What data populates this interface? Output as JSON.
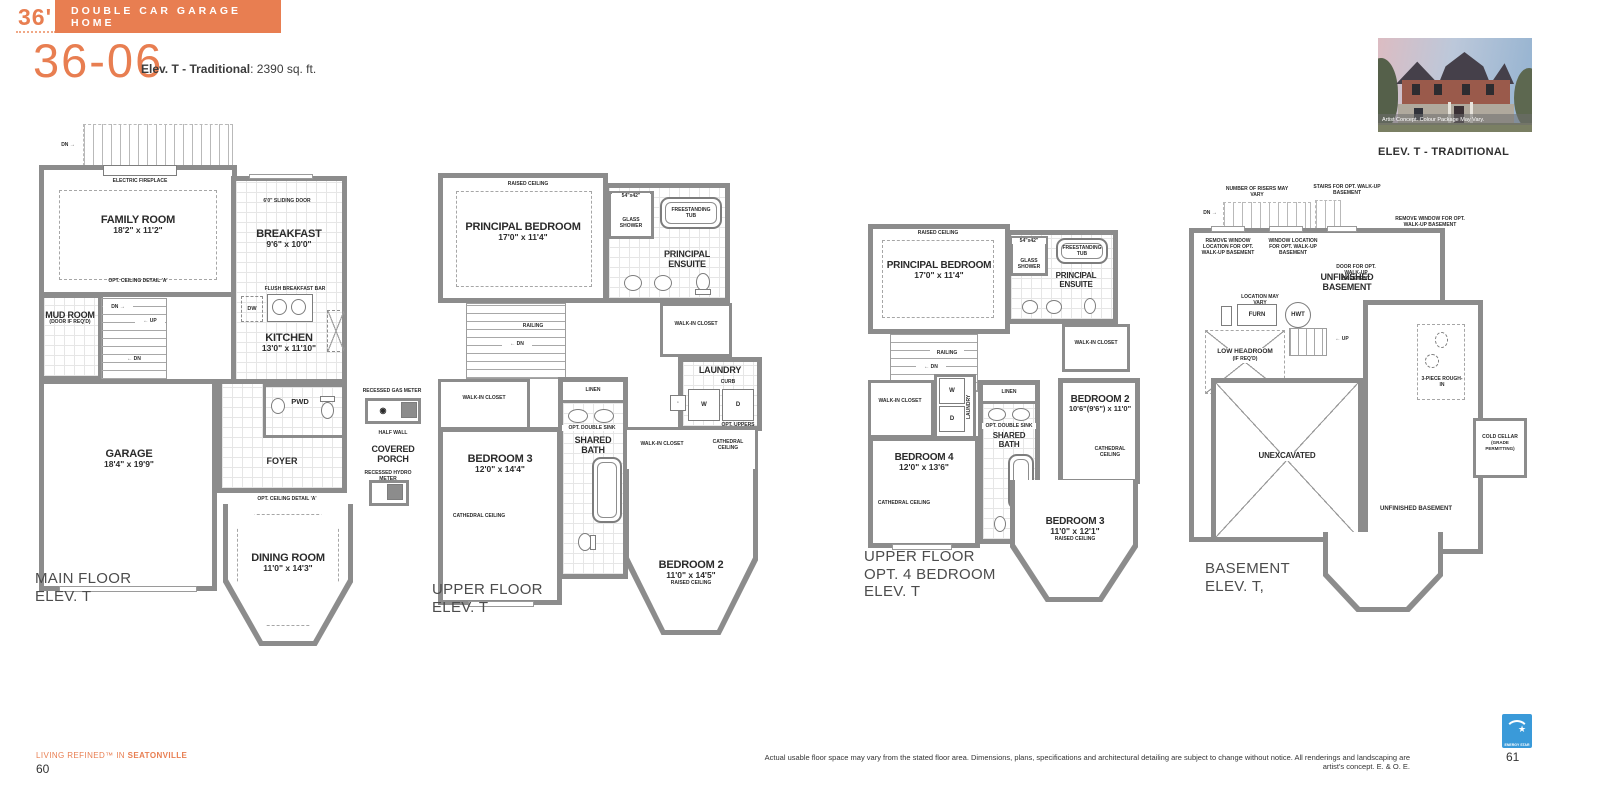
{
  "colors": {
    "accent": "#E87E51",
    "wall": "#8C8C8C",
    "energy_blue": "#3A9AD9"
  },
  "header": {
    "frontage": "36'",
    "banner": "DOUBLE CAR GARAGE HOME",
    "model": "36-06",
    "elev": "Elev. T - Traditional",
    "sqft": ": 2390 sq. ft."
  },
  "photo": {
    "caption": "Artist Concept. Colour Package May Vary.",
    "label": "ELEV. T - TRADITIONAL"
  },
  "plan_main": {
    "caption1": "MAIN FLOOR",
    "caption2": "ELEV. T",
    "family": {
      "name": "FAMILY ROOM",
      "dims": "18'2\" x 11'2\""
    },
    "breakfast": {
      "name": "BREAKFAST",
      "dims": "9'6\" x 10'0\""
    },
    "kitchen": {
      "name": "KITCHEN",
      "dims": "13'0\" x 11'10\""
    },
    "garage": {
      "name": "GARAGE",
      "dims": "18'4\" x 19'9\""
    },
    "dining": {
      "name": "DINING ROOM",
      "dims": "11'0\" x 14'3\""
    },
    "mudroom": {
      "name": "MUD ROOM",
      "note": "(DOOR IF REQ'D)"
    },
    "foyer": "FOYER",
    "pwd": "PWD",
    "covered_porch": "COVERED PORCH",
    "ann": {
      "electric_fireplace": "ELECTRIC FIREPLACE",
      "opt_ceiling": "OPT. CEILING DETAIL 'A'",
      "sliding_door": "6'0\" SLIDING DOOR",
      "flush_bar": "FLUSH BREAKFAST BAR",
      "dw": "DW",
      "recessed_gas": "RECESSED GAS METER",
      "half_wall": "HALF WALL",
      "recessed_hydro": "RECESSED HYDRO METER",
      "door_grade": "DOOR WHERE GRADE PERMITS",
      "dn_right": "DN →",
      "up_left": "← UP",
      "dn_left": "← DN"
    }
  },
  "plan_upper": {
    "caption1": "UPPER FLOOR",
    "caption2": "ELEV. T",
    "principal": {
      "name": "PRINCIPAL BEDROOM",
      "dims": "17'0\" x 11'4\"",
      "raised": "RAISED CEILING"
    },
    "ensuite": "PRINCIPAL ENSUITE",
    "shower": {
      "dims": "54\"x42\"",
      "name": "GLASS SHOWER"
    },
    "tub": "FREESTANDING TUB",
    "wic": "WALK-IN CLOSET",
    "laundry": {
      "name": "LAUNDRY",
      "curb": "CURB",
      "w": "W",
      "d": "D",
      "uppers": "OPT. UPPERS"
    },
    "railing": "RAILING",
    "dn": "← DN",
    "linen": "LINEN",
    "opt_double_sink": "OPT. DOUBLE SINK",
    "shared_bath": "SHARED BATH",
    "bedroom3": {
      "name": "BEDROOM 3",
      "dims": "12'0\" x 14'4\"",
      "cathedral": "CATHEDRAL CEILING"
    },
    "bedroom2": {
      "name": "BEDROOM 2",
      "dims": "11'0\" x 14'5\"",
      "raised": "RAISED CEILING",
      "cathedral": "CATHEDRAL CEILING"
    }
  },
  "plan_opt4": {
    "caption1": "UPPER FLOOR",
    "caption2": "OPT. 4 BEDROOM",
    "caption3": "ELEV. T",
    "principal": {
      "name": "PRINCIPAL BEDROOM",
      "dims": "17'0\" x 11'4\"",
      "raised": "RAISED CEILING"
    },
    "ensuite": "PRINCIPAL ENSUITE",
    "shower": {
      "dims": "54\"x42\"",
      "name": "GLASS SHOWER"
    },
    "tub": "FREESTANDING TUB",
    "wic": "WALK-IN CLOSET",
    "laundry": {
      "name": "LAUNDRY",
      "w": "W",
      "d": "D"
    },
    "railing": "RAILING",
    "dn": "← DN",
    "linen": "LINEN",
    "opt_double_sink": "OPT. DOUBLE SINK",
    "shared_bath": "SHARED BATH",
    "bedroom4": {
      "name": "BEDROOM 4",
      "dims": "12'0\" x 13'6\"",
      "cathedral": "CATHEDRAL CEILING"
    },
    "bedroom2": {
      "name": "BEDROOM 2",
      "dims": "10'6\"(9'6\") x 11'0\"",
      "cathedral": "CATHEDRAL CEILING"
    },
    "bedroom3": {
      "name": "BEDROOM 3",
      "dims": "11'0\" x 12'1\"",
      "raised": "RAISED CEILING"
    }
  },
  "plan_basement": {
    "caption1": "BASEMENT",
    "caption2": "ELEV. T,",
    "num_risers": "NUMBER OF RISERS MAY VARY",
    "stairs_opt": "STAIRS FOR OPT. WALK-UP BASEMENT",
    "remove_window_loc": "REMOVE WINDOW LOCATION FOR OPT. WALK-UP BASEMENT",
    "window_loc": "WINDOW LOCATION FOR OPT. WALK-UP BASEMENT",
    "door_opt": "DOOR FOR OPT. WALK-UP BASEMENT",
    "remove_window": "REMOVE WINDOW FOR OPT. WALK-UP BASEMENT",
    "unfinished": "UNFINISHED BASEMENT",
    "location_vary": "LOCATION MAY VARY",
    "furn": "FURN",
    "hwt": "HWT",
    "low_headroom": "LOW HEADROOM",
    "low_headroom_note": "(IF REQ'D)",
    "up": "← UP",
    "dn": "DN →",
    "unexcavated": "UNEXCAVATED",
    "three_piece": "3-PIECE ROUGH-IN",
    "cold_cellar": "COLD CELLAR",
    "cold_cellar_note": "(GRADE PERMITTING)",
    "unfinished2": "UNFINISHED BASEMENT"
  },
  "footer": {
    "tagline_pre": "LIVING REFINED™ IN ",
    "tagline_bold": "SEATONVILLE",
    "page_left": "60",
    "disclaimer": "Actual usable floor space may vary from the stated floor area. Dimensions, plans, specifications and architectural detailing are subject to change without notice. All renderings and landscaping are artist's concept. E. & O. E.",
    "page_right": "61",
    "energy_label": "ENERGY STAR"
  }
}
